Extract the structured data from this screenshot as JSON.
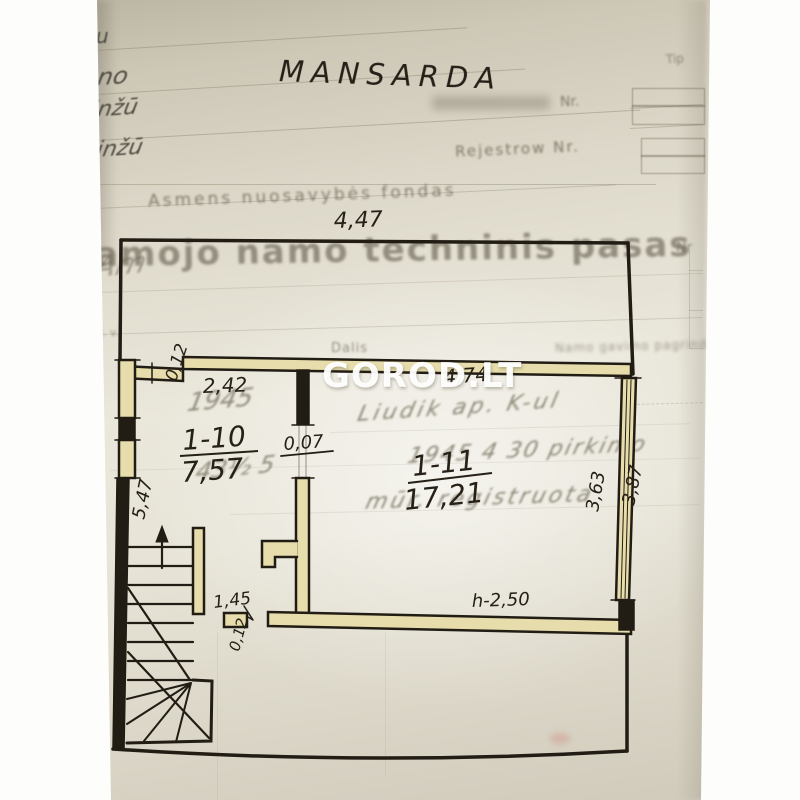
{
  "watermark_text": "GOROD.LT",
  "plan": {
    "title": "MANSARDA",
    "rooms": {
      "r110": {
        "id": "1-10",
        "area": "7,57"
      },
      "r111": {
        "id": "1-11",
        "area": "17,21"
      }
    },
    "dims": {
      "top_width": "4,47",
      "top_jog": "0,12",
      "room110_width": "2,42",
      "room111_width": "4,74",
      "door_gap": "0,07",
      "left_height": "5,47",
      "right_height_inner": "3,63",
      "right_height_outer": "3,87",
      "bottom_opening": "1,45",
      "bottom_jog": "0,12",
      "ceiling_height": "h-2,50"
    }
  },
  "form": {
    "type_label": "Tip",
    "inventory_nr_label": "Nr.",
    "register_label": "Rejestrow Nr.",
    "fund_line": "Asmens nuosavybės fondas",
    "passport_heading": "amojo namo techninis pasas",
    "nr_label": "Nr",
    "col_lv": "l. v.",
    "col_dalis": "Dalis",
    "col_basis": "Namo gavimo pagrindas"
  },
  "handwriting": {
    "margin_note_1": "u",
    "margin_note_2": "no",
    "margin_note_3": "inžū",
    "margin_note_4": "inžū",
    "margin_flourish": "Am",
    "pencil_year": "1945",
    "pencil_row_1": "Liudik ap. K-ul",
    "pencil_row_2": "1945 4 30 pirkimo",
    "pencil_fraction": "43½ 5",
    "pencil_row_3": "mūr. registruota"
  }
}
